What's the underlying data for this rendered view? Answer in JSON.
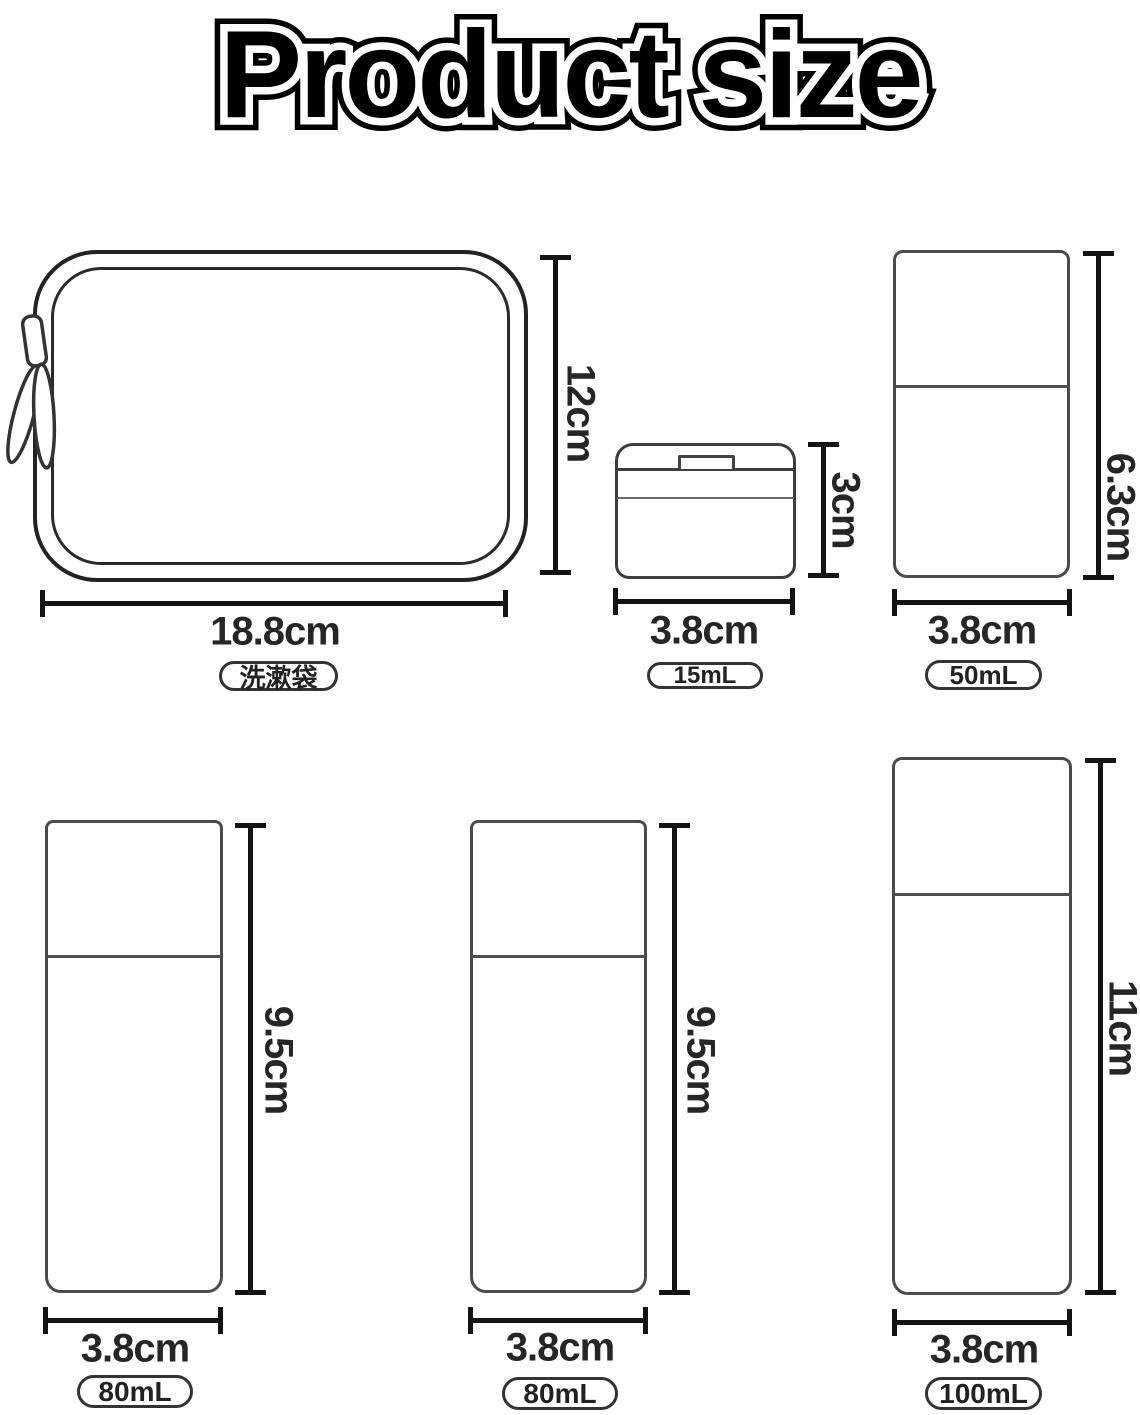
{
  "title": "Product size",
  "products": {
    "bag": {
      "height": "12cm",
      "width": "18.8cm",
      "label": "洗漱袋"
    },
    "jar15": {
      "height": "3cm",
      "width": "3.8cm",
      "label": "15mL"
    },
    "bottle50": {
      "height": "6.3cm",
      "width": "3.8cm",
      "label": "50mL"
    },
    "bottle80a": {
      "height": "9.5cm",
      "width": "3.8cm",
      "label": "80mL"
    },
    "bottle80b": {
      "height": "9.5cm",
      "width": "3.8cm",
      "label": "80mL"
    },
    "bottle100": {
      "height": "11cm",
      "width": "3.8cm",
      "label": "100mL"
    }
  },
  "icons": {
    "zipper_pull": "zipper-pull-icon"
  },
  "colors": {
    "background": "#ffffff",
    "dimension_line": "#141414",
    "product_outline": "#4b4b4b",
    "text": "#262626"
  }
}
